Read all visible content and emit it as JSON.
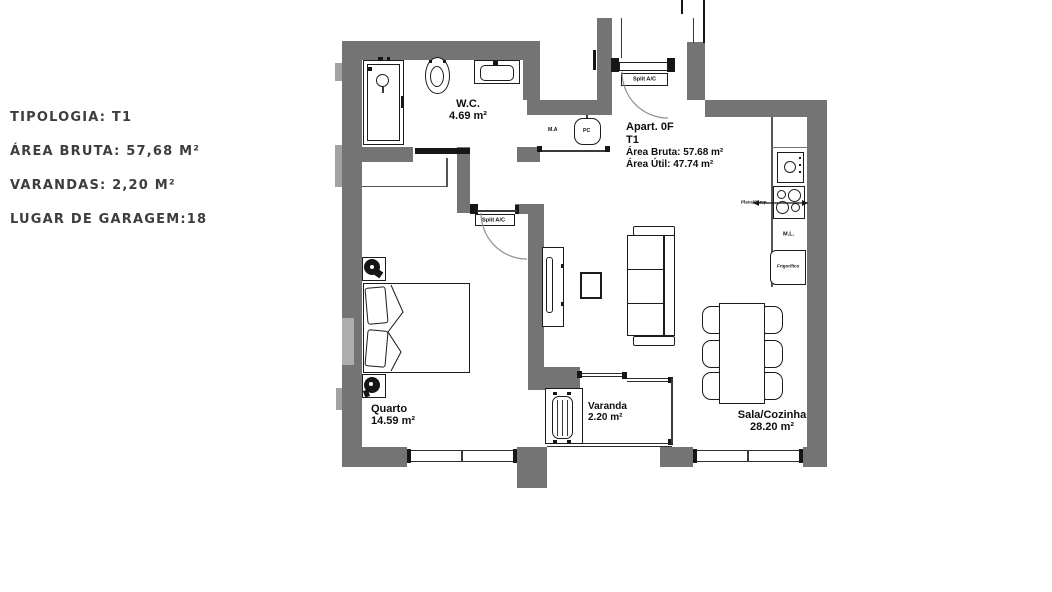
{
  "info_panel": {
    "lines": [
      "TIPOLOGIA: T1",
      "ÁREA BRUTA: 57,68 M²",
      "VARANDAS: 2,20 M²",
      "LUGAR DE GARAGEM:18"
    ]
  },
  "apartment_block": {
    "name": "Apart. 0F",
    "type": "T1",
    "gross_area": "Área Bruta: 57.68 m²",
    "net_area": "Área Útil: 47.74 m²"
  },
  "rooms": {
    "wc": {
      "name": "W.C.",
      "area": "4.69 m²"
    },
    "bedroom": {
      "name": "Quarto",
      "area": "14.59 m²"
    },
    "balcony": {
      "name": "Varanda",
      "area": "2.20 m²"
    },
    "living_kitchen": {
      "name": "Sala/Cozinha",
      "area": "28.20 m²"
    }
  },
  "labels": {
    "split_ac_entrance": "Split A/C",
    "split_ac_bedroom": "Split A/C",
    "laundry": "M.A",
    "pc": "PC",
    "dishwasher": "M.L.",
    "fridge": "Frigorífico",
    "hob": "Placa/Camp."
  },
  "colors": {
    "wall": "#747474",
    "wall_light": "#a2a2a2",
    "line": "#161616",
    "info_text": "#3d3d3d"
  }
}
